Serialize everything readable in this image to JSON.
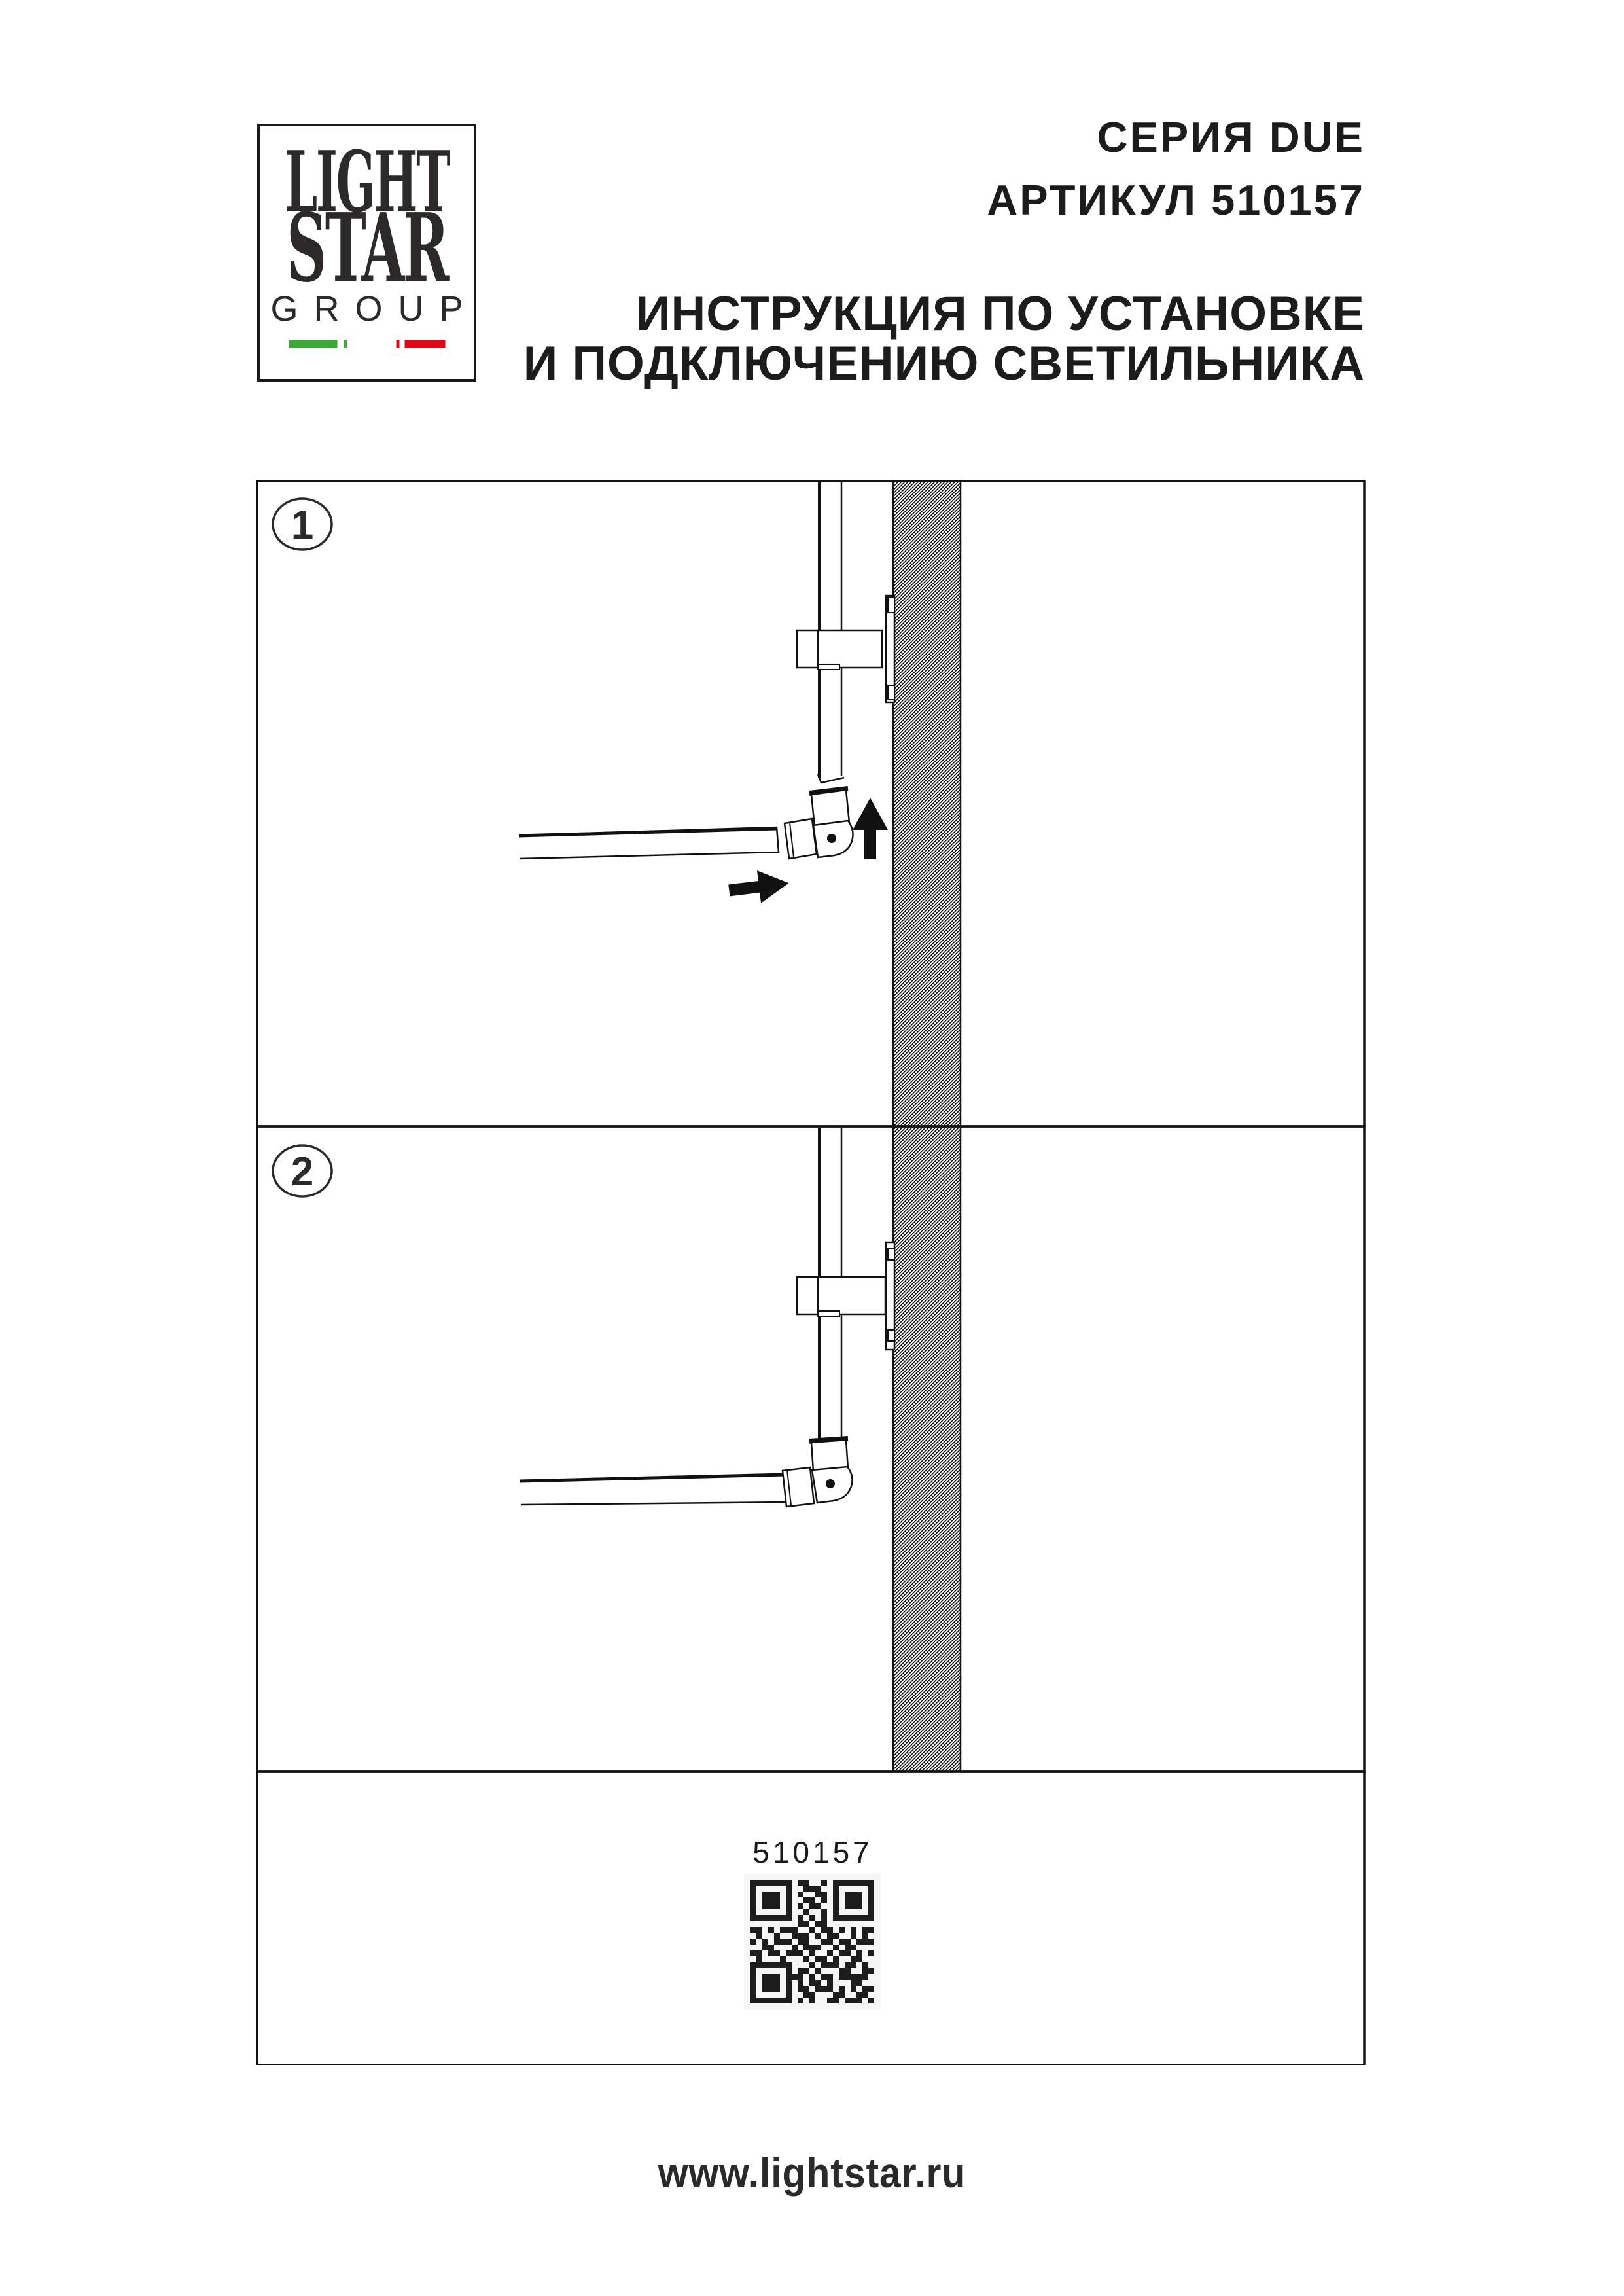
{
  "logo": {
    "line1": "LIGHT",
    "line2": "STAR",
    "line3": "GROUP",
    "flag_colors": {
      "green": "#3aa935",
      "white": "#ffffff",
      "red": "#e30613"
    }
  },
  "header": {
    "series": "СЕРИЯ DUE",
    "article": "АРТИКУЛ 510157",
    "instruction_line1": "ИНСТРУКЦИЯ ПО УСТАНОВКЕ",
    "instruction_line2": "И ПОДКЛЮЧЕНИЮ СВЕТИЛЬНИКА"
  },
  "steps": [
    {
      "number": "1"
    },
    {
      "number": "2"
    }
  ],
  "bottom_panel": {
    "article_code": "510157"
  },
  "footer": {
    "url": "www.lightstar.ru"
  },
  "colors": {
    "ink": "#1a1a1a",
    "hatch": "#000000"
  },
  "qr": {
    "matrix": [
      "111111101100101111111",
      "100000100111001000001",
      "101110101001101011101",
      "101110100110101011101",
      "101110101011001011101",
      "100000100100101000001",
      "111111101010101111111",
      "000000001101100000000",
      "110101110010110101011",
      "010010011101011001010",
      "101011101100110110111",
      "001100010111001011000",
      "110110111010010110101",
      "010001000101101001100",
      "111111100010111011010",
      "100000101101000110011",
      "101110111010110111110",
      "101110101011010001100",
      "101110101101110101011",
      "100000100110001100110",
      "111111101010011011101"
    ]
  }
}
